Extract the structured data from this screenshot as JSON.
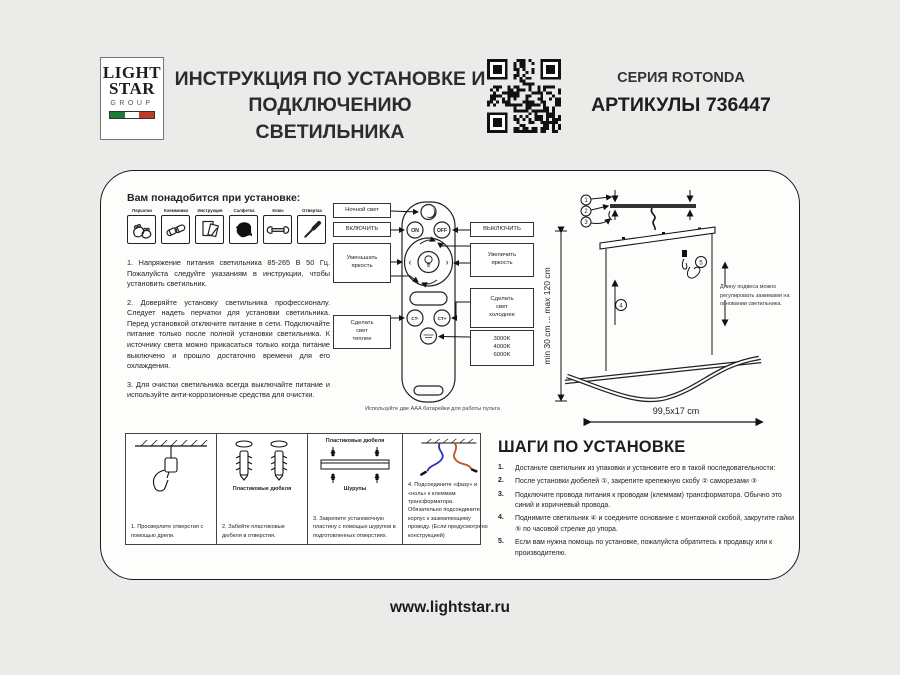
{
  "header": {
    "logo": {
      "line1": "LIGHT",
      "line2": "STAR",
      "line3": "GROUP"
    },
    "title": "ИНСТРУКЦИЯ ПО УСТАНОВКЕ И\nПОДКЛЮЧЕНИЮ СВЕТИЛЬНИКА",
    "series": "СЕРИЯ ROTONDA",
    "article": "АРТИКУЛЫ 736447"
  },
  "needs": {
    "heading": "Вам понадобится при установке:",
    "tools": [
      {
        "label": "Перчатки"
      },
      {
        "label": "Клеммники"
      },
      {
        "label": "Инструкция"
      },
      {
        "label": "Салфетка"
      },
      {
        "label": "Ключ"
      },
      {
        "label": "Отвертка"
      }
    ]
  },
  "notes": {
    "p1": "1. Напряжение питания светильника 85-265 В 50 Гц. Пожалуйста следуйте указаниям в инструкции, чтобы установить светильник.",
    "p2": "2. Доверяйте установку светильника профессионалу. Следует надеть перчатки для установки светильника. Перед установкой отключите питание в сети. Подключайте питание только после полной установки светильника. К источнику света можно прикасаться только когда питание выключено и прошло достаточно времени для его охлаждения.",
    "p3": "3. Для очистки светильника всегда выключайте питание и используйте анти-коррозионные средства для очистки."
  },
  "remote": {
    "labels": {
      "night": "Ночной свет",
      "on": "ВКЛЮЧИТЬ",
      "off": "ВЫКЛЮЧИТЬ",
      "dim": "Уменьшать\nяркость",
      "brighten": "Увеличить\nяркость",
      "cooler": "Сделать\nсвет\nхолоднее",
      "warmer": "Сделать\nсвет\nтеплее",
      "kelvin": "3000K\n4000K\n6000K"
    },
    "buttons": {
      "on": "ON",
      "off": "OFF",
      "ct_minus": "CT-",
      "ct_plus": "CT+"
    },
    "caption": "Используйте две AAA батарейки для работы пульта"
  },
  "diagram": {
    "height_range": "min 30 cm ... max 120 cm",
    "width_dim": "99,5x17 cm",
    "adjust_note": "Длину подвеса можно регулировать зажимами на основании светильника.",
    "callouts": [
      "1",
      "2",
      "3",
      "4",
      "5"
    ]
  },
  "mount": {
    "cells": [
      {
        "caption": "1. Просверлите отверстия с помощью дрели."
      },
      {
        "label": "Пластиковые дюбеля",
        "caption": "2. Забейте пластиковые дюбеля в отверстия."
      },
      {
        "label_top": "Пластиковые дюбеля",
        "label_bottom": "Шурупы",
        "caption": "3. Закрепите установочную пластину с помощью шурупов в подготовленных отверстиях."
      },
      {
        "caption": "4. Подсоедините «фазу» и «ноль» к клеммам трансформатора. Обязательно подсоедините корпус к заземляющему проводу. (Если предусмотрено конструкцией)"
      }
    ]
  },
  "install": {
    "heading": "ШАГИ ПО УСТАНОВКЕ",
    "steps": [
      {
        "num": "1.",
        "text": "Достаньте светильник из упаковки и установите его в такой последовательности:"
      },
      {
        "num": "2.",
        "text": "После установки дюбелей ①, закрепите крепежную скобу ② саморезами ③"
      },
      {
        "num": "3.",
        "text": "Подключите провода питания к проводам (клеммам) трансформатора. Обычно это синий и коричневый провода."
      },
      {
        "num": "4.",
        "text": "Поднимите светильник ④ и соедините основание с монтажной скобой, закрутите гайки ⑤ по часовой стрелке до упора."
      },
      {
        "num": "5.",
        "text": "Если вам нужна помощь по установке, пожалуйста обратитесь к продавцу или к производителю."
      }
    ]
  },
  "footer": {
    "url": "www.lightstar.ru"
  },
  "colors": {
    "wire_blue": "#2a35b8",
    "wire_brown": "#c4541f",
    "flag_green": "#1e7b38",
    "flag_white": "#ffffff",
    "flag_red": "#c0392b"
  }
}
